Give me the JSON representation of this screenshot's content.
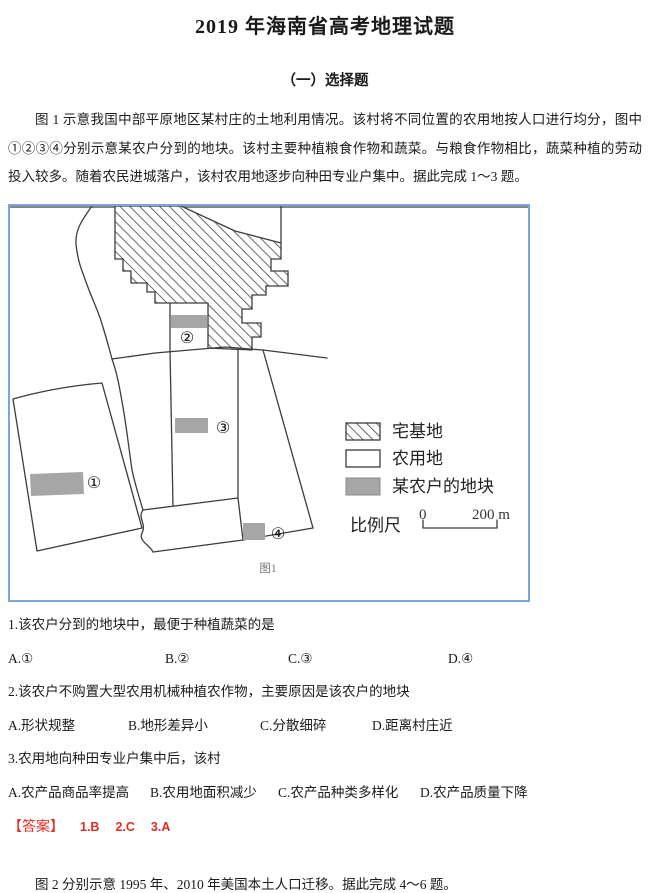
{
  "page": {
    "title": "2019 年海南省高考地理试题",
    "section_heading": "（一）选择题",
    "intro_paragraph": "图 1 示意我国中部平原地区某村庄的土地利用情况。该村将不同位置的农用地按人口进行均分，图中①②③④分别示意某农户分到的地块。该村主要种植粮食作物和蔬菜。与粮食作物相比，蔬菜种植的劳动投入较多。随着农民进城落户，该村农用地逐步向种田专业户集中。据此完成 1～3 题。",
    "closing_paragraph": "图 2 分别示意 1995 年、2010 年美国本土人口迁移。据此完成 4～6 题。"
  },
  "figure": {
    "caption": "图1",
    "plot_numbers": [
      "①",
      "②",
      "③",
      "④"
    ],
    "legend": [
      {
        "swatch": "hatched",
        "label": "宅基地"
      },
      {
        "swatch": "white",
        "label": "农用地"
      },
      {
        "swatch": "gray",
        "label": "某农户的地块"
      }
    ],
    "scale": {
      "label": "比例尺",
      "start": "0",
      "end": "200 m"
    }
  },
  "questions": [
    {
      "stem": "1.该农户分到的地块中，最便于种植蔬菜的是",
      "options": [
        "A.①",
        "B.②",
        "C.③",
        "D.④"
      ]
    },
    {
      "stem": "2.该农户不购置大型农用机械种植农作物，主要原因是该农户的地块",
      "options": [
        "A.形状规整",
        "B.地形差异小",
        "C.分散细碎",
        "D.距离村庄近"
      ]
    },
    {
      "stem": "3.农用地向种田专业户集中后，该村",
      "options": [
        "A.农产品商品率提高",
        "B.农用地面积减少",
        "C.农产品种类多样化",
        "D.农产品质量下降"
      ]
    }
  ],
  "answers": {
    "label": "【答案】",
    "items": [
      "1.B",
      "2.C",
      "3.A"
    ]
  },
  "colors": {
    "frame_blue": "#7ba4e0",
    "farmer_plot_gray": "#a6a6a6",
    "answer_red": "#e42b24",
    "map_line": "#3c3c3c"
  }
}
